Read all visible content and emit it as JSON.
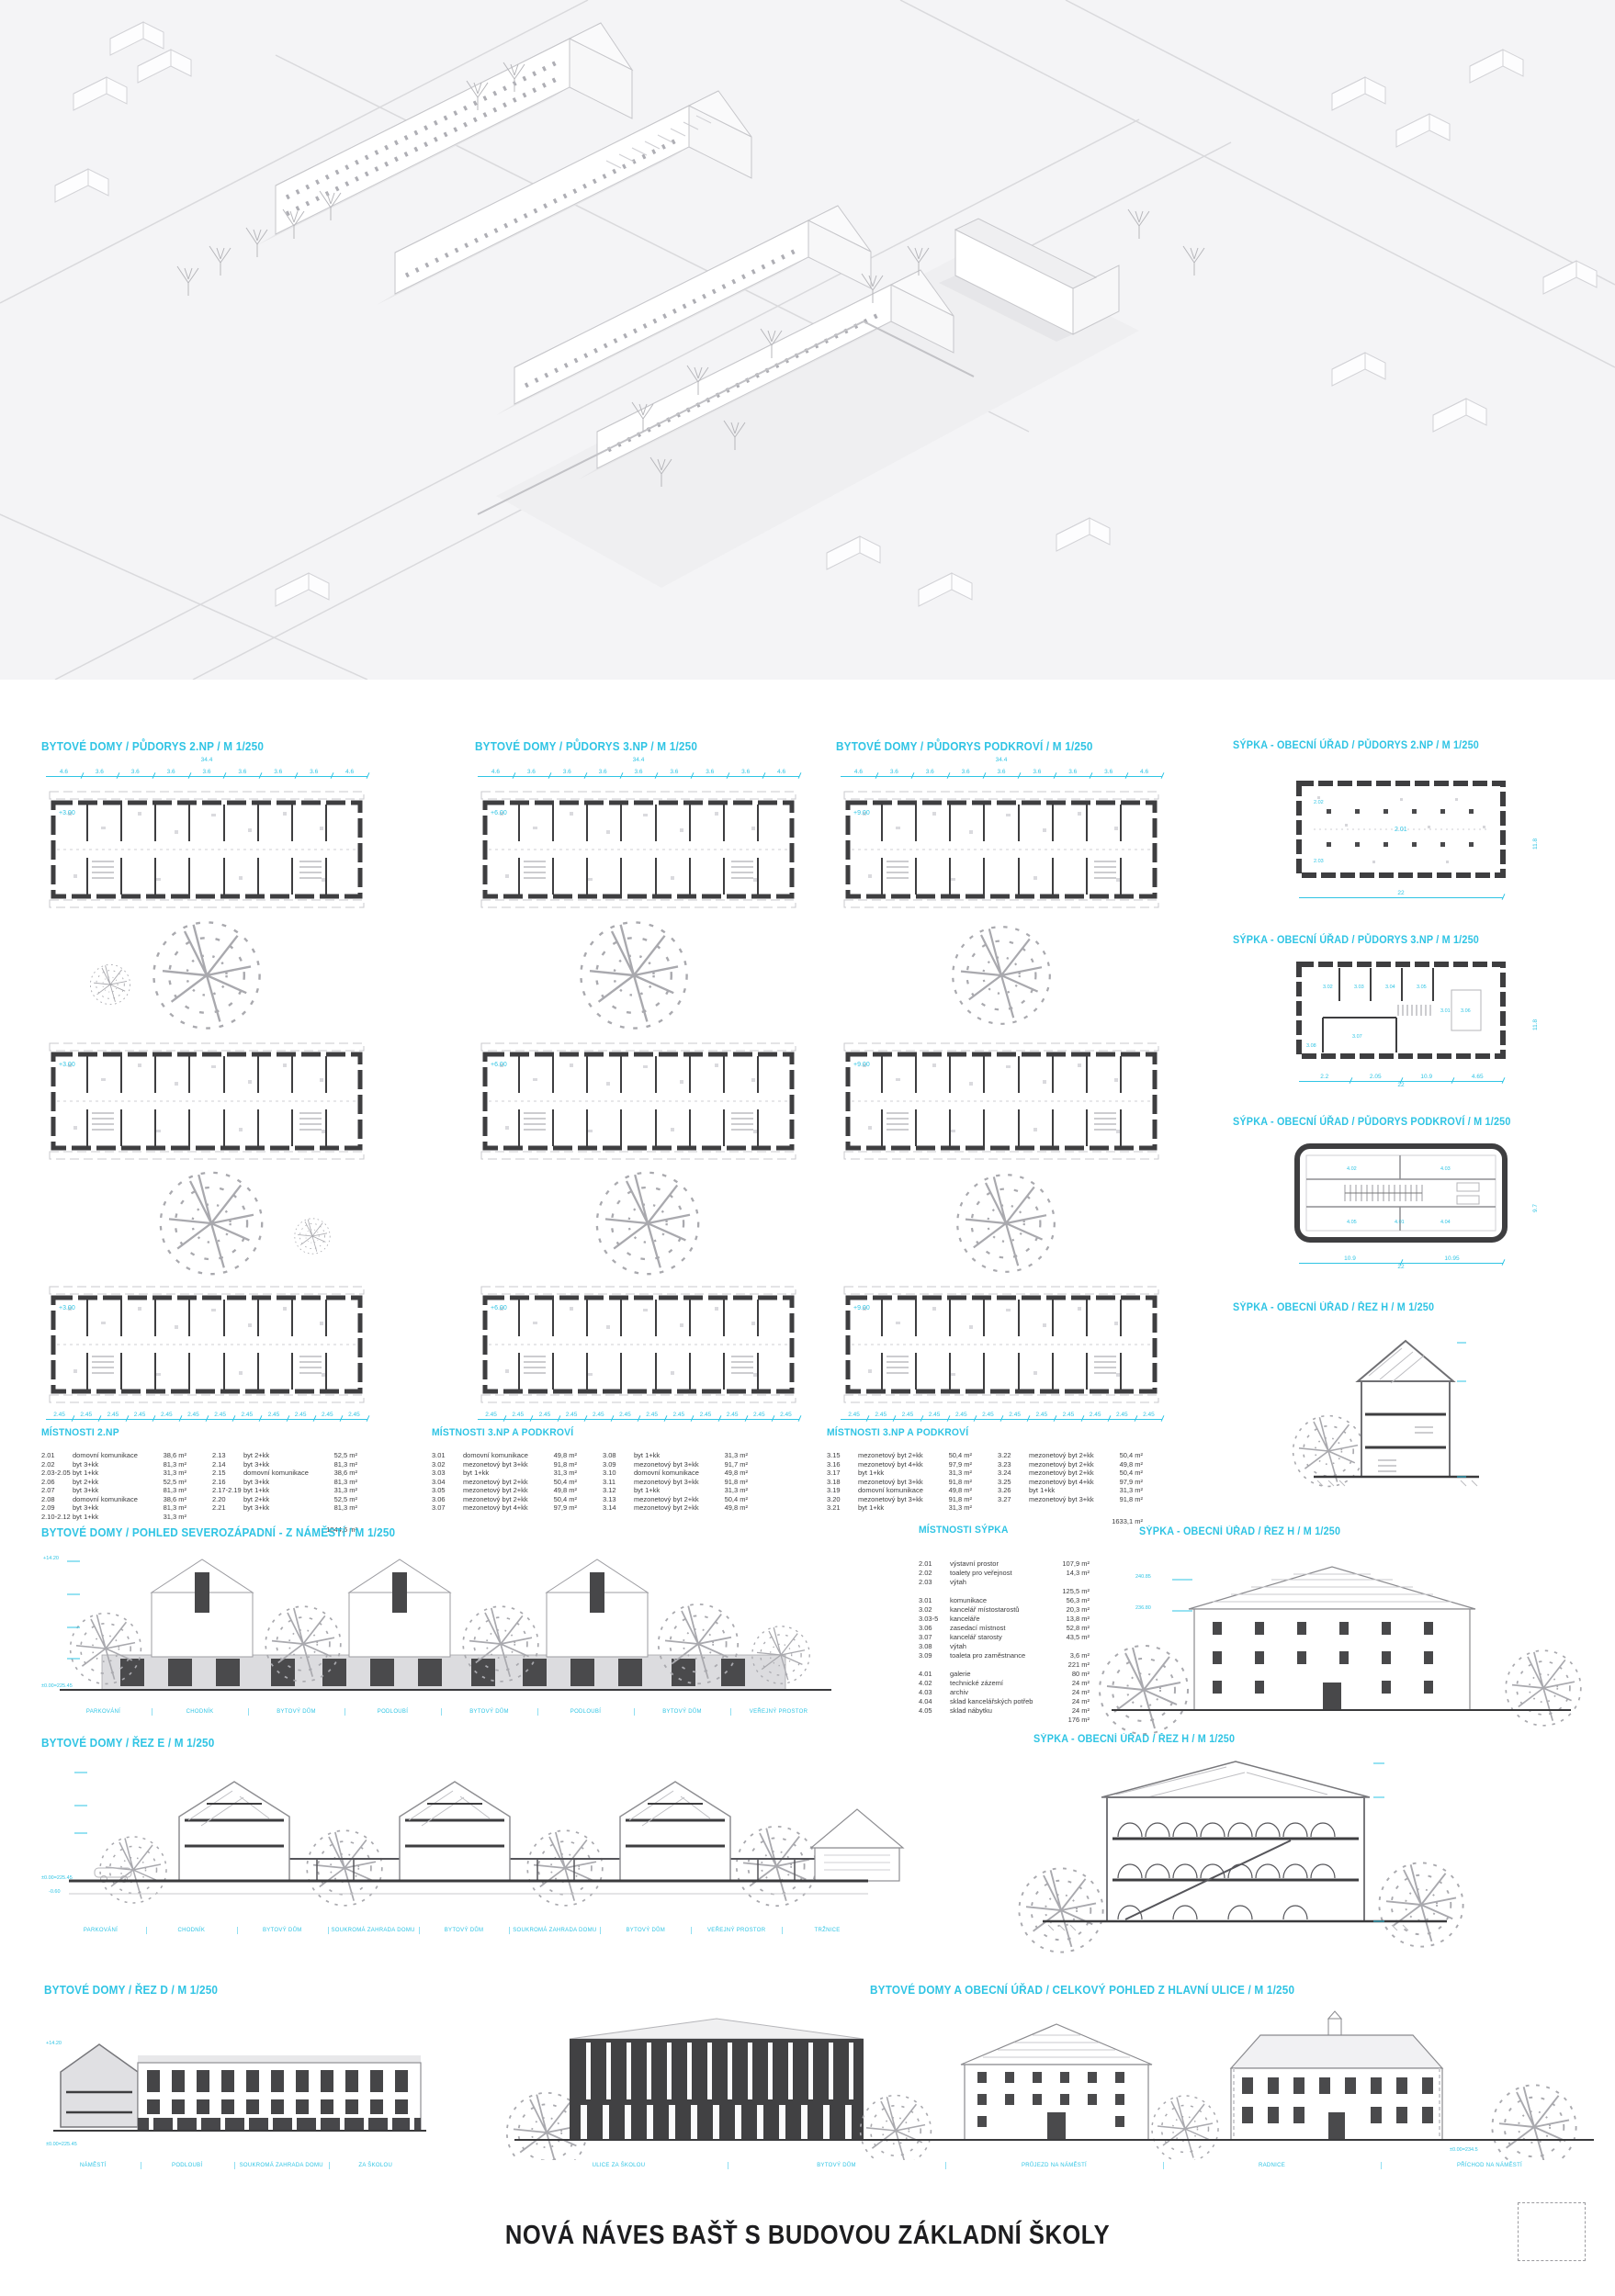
{
  "accent": "#2fc4e4",
  "board_title": "NOVÁ NÁVES BAŠŤ S BUDOVOU ZÁKLADNÍ ŠKOLY",
  "sections": {
    "plan_bd_2np": "BYTOVÉ DOMY / PŮDORYS 2.NP / M 1/250",
    "plan_bd_3np": "BYTOVÉ DOMY / PŮDORYS 3.NP / M 1/250",
    "plan_bd_pod": "BYTOVÉ DOMY / PŮDORYS PODKROVÍ / M 1/250",
    "plan_sypka_2np": "SÝPKA - OBECNÍ ÚŘAD / PŮDORYS 2.NP / M 1/250",
    "plan_sypka_3np": "SÝPKA - OBECNÍ ÚŘAD / PŮDORYS 3.NP / M 1/250",
    "plan_sypka_pod": "SÝPKA - OBECNÍ ÚŘAD / PŮDORYS PODKROVÍ / M 1/250",
    "sypka_rez_h": "SÝPKA - OBECNÍ ÚŘAD / ŘEZ H / M 1/250",
    "pohled_sz": "BYTOVÉ DOMY / POHLED SEVEROZÁPADNÍ - Z NÁMĚSTÍ / M 1/250",
    "rez_e": "BYTOVÉ DOMY / ŘEZ E / M 1/250",
    "rez_d": "BYTOVÉ DOMY / ŘEZ D / M 1/250",
    "celkovy": "BYTOVÉ DOMY A OBECNÍ ÚŘAD / CELKOVÝ POHLED Z HLAVNÍ ULICE / M 1/250"
  },
  "plans": {
    "bd": {
      "total": "34.4",
      "dims": [
        "4.6",
        "3.6",
        "3.6",
        "3.6",
        "3.6",
        "3.6",
        "3.6",
        "3.6",
        "4.6"
      ],
      "bottom": [
        "2.45",
        "2.45",
        "2.45",
        "2.45",
        "2.45",
        "2.45",
        "2.45",
        "2.45",
        "2.45",
        "2.45",
        "2.45",
        "2.45"
      ]
    },
    "bd2": {
      "level": "+3.00"
    },
    "bd3": {
      "level": "+6.00"
    },
    "bdp": {
      "level": "+9.00"
    }
  },
  "sypka": {
    "p2": {
      "dims": [
        "22"
      ],
      "side": "11.8",
      "rooms": [
        "2.01",
        "2.02",
        "2.03"
      ]
    },
    "p3": {
      "dims": [
        "2.2",
        "2.05",
        "10.9",
        "4.65"
      ],
      "total": "22",
      "side": "11.8",
      "rooms": [
        "3.01",
        "3.02",
        "3.03",
        "3.04",
        "3.05",
        "3.06",
        "3.07",
        "3.08"
      ]
    },
    "p4": {
      "dims": [
        "10.9",
        "10.95"
      ],
      "total": "22",
      "side": "9.7",
      "rooms": [
        "4.01",
        "4.02",
        "4.03",
        "4.04",
        "4.05"
      ]
    }
  },
  "marks": {
    "pohled_top": "+14.20",
    "base": "±0.00=225.45",
    "minus": "-0.60",
    "rezd_top": "+14.20",
    "sypka_hi": "240.85",
    "sypka_lo": "236.80",
    "skola_base": "±0.00=234.5"
  },
  "tables": {
    "t2np": {
      "title": "MÍSTNOSTI 2.NP",
      "a": [
        {
          "n": "2.01",
          "t": "domovní komunikace",
          "a": "38,6 m²"
        },
        {
          "n": "2.02",
          "t": "byt 3+kk",
          "a": "81,3 m²"
        },
        {
          "n": "2.03-2.05",
          "t": "byt 1+kk",
          "a": "31,3 m²"
        },
        {
          "n": "2.06",
          "t": "byt 2+kk",
          "a": "52,5 m²"
        },
        {
          "n": "2.07",
          "t": "byt 3+kk",
          "a": "81,3 m²"
        },
        {
          "n": "2.08",
          "t": "domovní komunikace",
          "a": "38,6 m²"
        },
        {
          "n": "2.09",
          "t": "byt 3+kk",
          "a": "81,3 m²"
        },
        {
          "n": "2.10-2.12",
          "t": "byt 1+kk",
          "a": "31,3 m²"
        }
      ],
      "b": [
        {
          "n": "2.13",
          "t": "byt 2+kk",
          "a": "52,5 m²"
        },
        {
          "n": "2.14",
          "t": "byt 3+kk",
          "a": "81,3 m²"
        },
        {
          "n": "2.15",
          "t": "domovní komunikace",
          "a": "38,6 m²"
        },
        {
          "n": "2.16",
          "t": "byt 3+kk",
          "a": "81,3 m²"
        },
        {
          "n": "2.17-2.19",
          "t": "byt 1+kk",
          "a": "31,3 m²"
        },
        {
          "n": "2.20",
          "t": "byt 2+kk",
          "a": "52,5 m²"
        },
        {
          "n": "2.21",
          "t": "byt 3+kk",
          "a": "81,3 m²"
        }
      ],
      "total": "1044,6 m²"
    },
    "t3a": {
      "title": "MÍSTNOSTI 3.NP A PODKROVÍ",
      "a": [
        {
          "n": "3.01",
          "t": "domovní komunikace",
          "a": "49,8 m²"
        },
        {
          "n": "3.02",
          "t": "mezonetový byt 3+kk",
          "a": "91,8 m²"
        },
        {
          "n": "3.03",
          "t": "byt 1+kk",
          "a": "31,3 m²"
        },
        {
          "n": "3.04",
          "t": "mezonetový byt 2+kk",
          "a": "50,4 m²"
        },
        {
          "n": "3.05",
          "t": "mezonetový byt 2+kk",
          "a": "49,8 m²"
        },
        {
          "n": "3.06",
          "t": "mezonetový byt 2+kk",
          "a": "50,4 m²"
        },
        {
          "n": "3.07",
          "t": "mezonetový byt 4+kk",
          "a": "97,9 m²"
        }
      ],
      "b": [
        {
          "n": "3.08",
          "t": "byt 1+kk",
          "a": "31,3 m²"
        },
        {
          "n": "3.09",
          "t": "mezonetový byt 3+kk",
          "a": "91,7 m²"
        },
        {
          "n": "3.10",
          "t": "domovní komunikace",
          "a": "49,8 m²"
        },
        {
          "n": "3.11",
          "t": "mezonetový byt 3+kk",
          "a": "91,8 m²"
        },
        {
          "n": "3.12",
          "t": "byt 1+kk",
          "a": "31,3 m²"
        },
        {
          "n": "3.13",
          "t": "mezonetový byt 2+kk",
          "a": "50,4 m²"
        },
        {
          "n": "3.14",
          "t": "mezonetový byt 2+kk",
          "a": "49,8 m²"
        }
      ]
    },
    "t3b": {
      "title": "MÍSTNOSTI 3.NP A PODKROVÍ",
      "a": [
        {
          "n": "3.15",
          "t": "mezonetový byt 2+kk",
          "a": "50,4 m²"
        },
        {
          "n": "3.16",
          "t": "mezonetový byt 4+kk",
          "a": "97,9 m²"
        },
        {
          "n": "3.17",
          "t": "byt 1+kk",
          "a": "31,3 m²"
        },
        {
          "n": "3.18",
          "t": "mezonetový byt 3+kk",
          "a": "91,8 m²"
        },
        {
          "n": "3.19",
          "t": "domovní komunikace",
          "a": "49,8 m²"
        },
        {
          "n": "3.20",
          "t": "mezonetový byt 3+kk",
          "a": "91,8 m²"
        },
        {
          "n": "3.21",
          "t": "byt 1+kk",
          "a": "31,3 m²"
        }
      ],
      "b": [
        {
          "n": "3.22",
          "t": "mezonetový byt 2+kk",
          "a": "50,4 m²"
        },
        {
          "n": "3.23",
          "t": "mezonetový byt 2+kk",
          "a": "49,8 m²"
        },
        {
          "n": "3.24",
          "t": "mezonetový byt 2+kk",
          "a": "50,4 m²"
        },
        {
          "n": "3.25",
          "t": "mezonetový byt 4+kk",
          "a": "97,9 m²"
        },
        {
          "n": "3.26",
          "t": "byt 1+kk",
          "a": "31,3 m²"
        },
        {
          "n": "3.27",
          "t": "mezonetový byt 3+kk",
          "a": "91,8 m²"
        }
      ],
      "total": "1633,1 m²"
    },
    "sypka": {
      "title": "MÍSTNOSTI SÝPKA",
      "rows": [
        {
          "n": "2.01",
          "t": "výstavní prostor",
          "a": "107,9 m²"
        },
        {
          "n": "2.02",
          "t": "toalety pro veřejnost",
          "a": "14,3 m²"
        },
        {
          "n": "2.03",
          "t": "výtah",
          "a": ""
        },
        {
          "n": "",
          "t": "",
          "a": "125,5 m²"
        },
        {
          "n": "",
          "t": "",
          "a": ""
        },
        {
          "n": "3.01",
          "t": "komunikace",
          "a": "56,3 m²"
        },
        {
          "n": "3.02",
          "t": "kancelář místostarostů",
          "a": "20,3 m²"
        },
        {
          "n": "3.03-5",
          "t": "kanceláře",
          "a": "13,8 m²"
        },
        {
          "n": "3.06",
          "t": "zasedací místnost",
          "a": "52,8 m²"
        },
        {
          "n": "3.07",
          "t": "kancelář starosty",
          "a": "43,5 m²"
        },
        {
          "n": "3.08",
          "t": "výtah",
          "a": ""
        },
        {
          "n": "3.09",
          "t": "toaleta pro zaměstnance",
          "a": "3,6 m²"
        },
        {
          "n": "",
          "t": "",
          "a": "221 m²"
        },
        {
          "n": "",
          "t": "",
          "a": ""
        },
        {
          "n": "4.01",
          "t": "galerie",
          "a": "80 m²"
        },
        {
          "n": "4.02",
          "t": "technické zázemí",
          "a": "24 m²"
        },
        {
          "n": "4.03",
          "t": "archiv",
          "a": "24 m²"
        },
        {
          "n": "4.04",
          "t": "sklad kancelářských potřeb",
          "a": "24 m²"
        },
        {
          "n": "4.05",
          "t": "sklad nábytku",
          "a": "24 m²"
        },
        {
          "n": "",
          "t": "",
          "a": "176 m²"
        }
      ]
    }
  },
  "labels": {
    "pohled": [
      "PARKOVÁNÍ",
      "CHODNÍK",
      "BYTOVÝ DŮM",
      "PODLOUBÍ",
      "BYTOVÝ DŮM",
      "PODLOUBÍ",
      "BYTOVÝ DŮM",
      "VEŘEJNÝ PROSTOR"
    ],
    "reze": [
      "PARKOVÁNÍ",
      "CHODNÍK",
      "BYTOVÝ DŮM",
      "SOUKROMÁ ZAHRADA DOMU",
      "BYTOVÝ DŮM",
      "SOUKROMÁ ZAHRADA DOMU",
      "BYTOVÝ DŮM",
      "VEŘEJNÝ PROSTOR",
      "TRŽNICE"
    ],
    "rezd": [
      "NÁMĚSTÍ",
      "PODLOUBÍ",
      "SOUKROMÁ ZAHRADA DOMU",
      "ZA ŠKOLOU"
    ],
    "celkovy": [
      "ULICE ZA ŠKOLOU",
      "BYTOVÝ DŮM",
      "PRŮJEZD NA NÁMĚSTÍ",
      "RADNICE",
      "PŘÍCHOD NA NÁMĚSTÍ"
    ]
  }
}
